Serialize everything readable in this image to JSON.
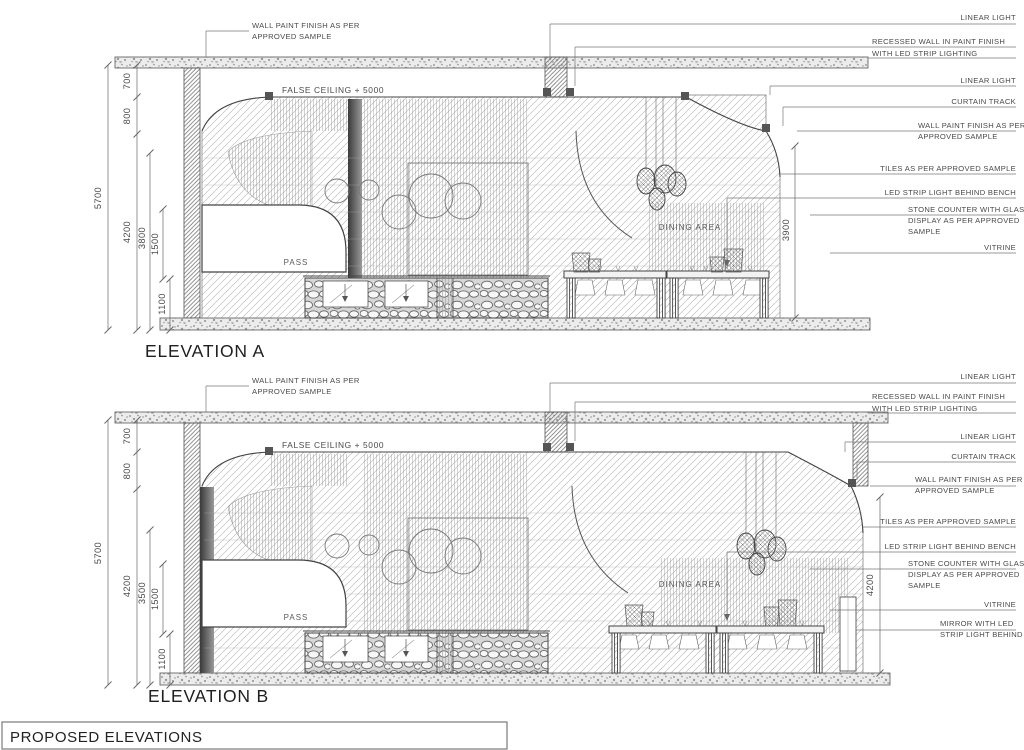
{
  "title_block": {
    "title": "PROPOSED ELEVATIONS"
  },
  "elevation_a": {
    "title": "ELEVATION A",
    "wall_note": {
      "l1": "WALL PAINT FINISH AS PER",
      "l2": "APPROVED SAMPLE"
    },
    "false_ceiling_label": "FALSE CEILING + 5000",
    "pass_label": "PASS",
    "dining_label": "DINING AREA",
    "dims": {
      "overall": "5700",
      "soffit": "700",
      "bulkhead": "800",
      "wall": "4200",
      "inner": "3800",
      "mid": "1500",
      "base": "1100",
      "right": "3900"
    },
    "ann": {
      "linear_light_top": "LINEAR LIGHT",
      "recessed_l1": "RECESSED WALL IN PAINT FINISH",
      "recessed_l2": "WITH LED STRIP LIGHTING",
      "linear_light": "LINEAR LIGHT",
      "curtain_track": "CURTAIN TRACK",
      "wall_paint_l1": "WALL PAINT FINISH AS PER",
      "wall_paint_l2": "APPROVED SAMPLE",
      "tiles": "TILES AS PER APPROVED SAMPLE",
      "led_strip": "LED STRIP LIGHT BEHIND BENCH",
      "stone_l1": "STONE COUNTER WITH GLASS",
      "stone_l2": "DISPLAY AS PER APPROVED",
      "stone_l3": "SAMPLE",
      "vitrine": "VITRINE"
    }
  },
  "elevation_b": {
    "title": "ELEVATION B",
    "wall_note": {
      "l1": "WALL PAINT FINISH AS PER",
      "l2": "APPROVED SAMPLE"
    },
    "false_ceiling_label": "FALSE CEILING + 5000",
    "pass_label": "PASS",
    "dining_label": "DINING AREA",
    "dims": {
      "overall": "5700",
      "soffit": "700",
      "bulkhead": "800",
      "wall": "4200",
      "inner": "3500",
      "mid": "1500",
      "base": "1100",
      "right": "4200"
    },
    "ann": {
      "linear_light_top": "LINEAR LIGHT",
      "recessed_l1": "RECESSED WALL IN PAINT FINISH",
      "recessed_l2": "WITH LED STRIP LIGHTING",
      "linear_light": "LINEAR LIGHT",
      "curtain_track": "CURTAIN TRACK",
      "wall_paint_l1": "WALL PAINT FINISH AS PER",
      "wall_paint_l2": "APPROVED SAMPLE",
      "tiles": "TILES AS PER APPROVED SAMPLE",
      "led_strip": "LED STRIP LIGHT BEHIND BENCH",
      "stone_l1": "STONE COUNTER WITH GLASS",
      "stone_l2": "DISPLAY AS PER APPROVED",
      "stone_l3": "SAMPLE",
      "vitrine": "VITRINE",
      "mirror_l1": "MIRROR WITH LED",
      "mirror_l2": "STRIP LIGHT BEHIND"
    }
  }
}
